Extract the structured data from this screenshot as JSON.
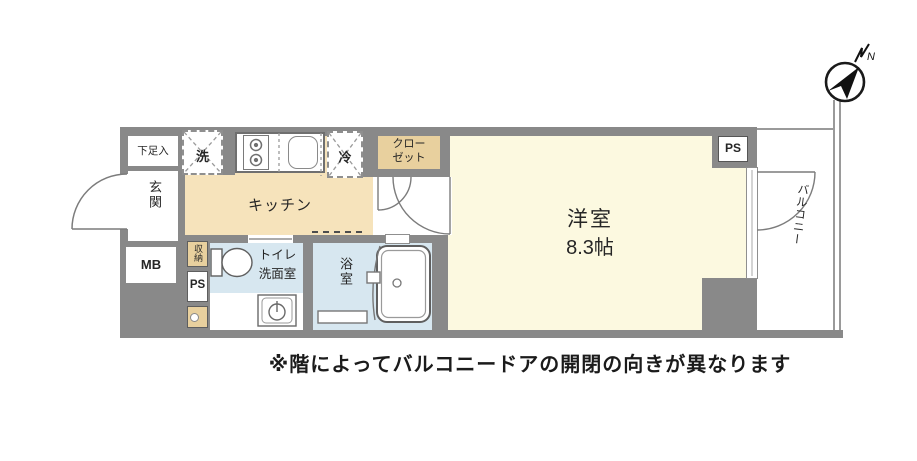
{
  "floorplan": {
    "rooms": {
      "shoe_box": "下足入",
      "entrance": "玄関",
      "meter_box": "MB",
      "washer": "洗",
      "kitchen": "キッチン",
      "fridge": "冷",
      "closet_line1": "クロー",
      "closet_line2": "ゼット",
      "pipe_space_top": "PS",
      "storage": "収納",
      "pipe_space_left": "PS",
      "toilet_line1": "トイレ",
      "toilet_line2": "洗面室",
      "bath": "浴室",
      "western_room": "洋室",
      "western_room_size": "8.3帖",
      "balcony": "バルコニー"
    },
    "compass": {
      "north_label": "N"
    },
    "note": "※階によってバルコニードアの開閉の向きが異なります",
    "colors": {
      "wall": "#898989",
      "kitchen_floor": "#f6e3bb",
      "western_room_floor": "#fcf9e0",
      "closet_fill": "#e8d09e",
      "wet_area_fill": "#d7e7f0",
      "fixture_line": "#666666"
    }
  }
}
